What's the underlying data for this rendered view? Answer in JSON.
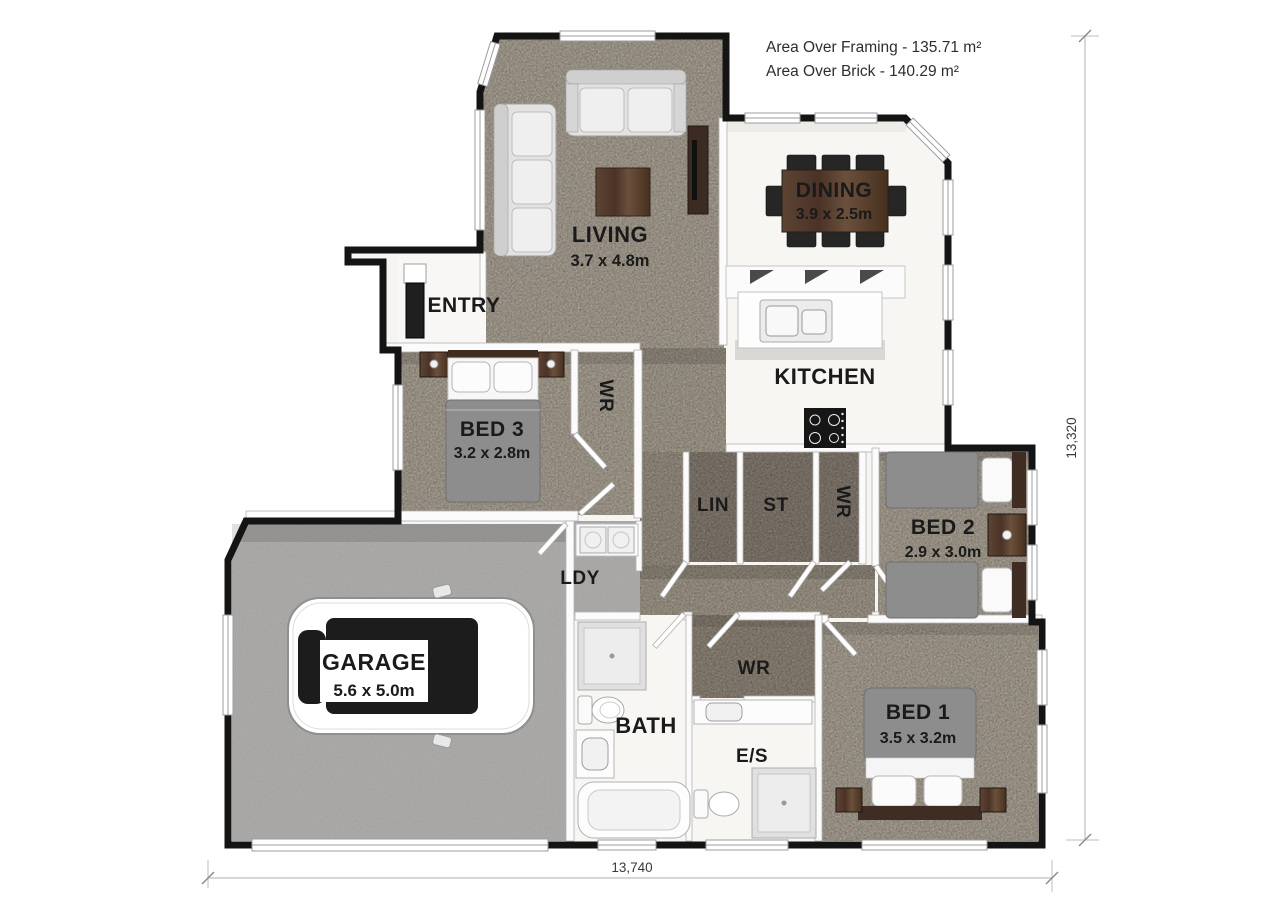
{
  "annotations": {
    "area_framing": "Area Over Framing - 135.71 m²",
    "area_brick": "Area Over Brick - 140.29 m²"
  },
  "dimensions": {
    "overall_width": "13,740",
    "overall_height": "13,320"
  },
  "rooms": {
    "living": {
      "label": "LIVING",
      "size": "3.7 x 4.8m"
    },
    "dining": {
      "label": "DINING",
      "size": "3.9 x 2.5m"
    },
    "kitchen": {
      "label": "KITCHEN"
    },
    "entry": {
      "label": "ENTRY"
    },
    "bed3": {
      "label": "BED 3",
      "size": "3.2 x 2.8m"
    },
    "bed3_wr": {
      "label": "WR"
    },
    "lin": {
      "label": "LIN"
    },
    "st": {
      "label": "ST"
    },
    "hall_wr": {
      "label": "WR"
    },
    "bed2": {
      "label": "BED 2",
      "size": "2.9 x 3.0m"
    },
    "ldy": {
      "label": "LDY"
    },
    "garage": {
      "label": "GARAGE",
      "size": "5.6 x 5.0m"
    },
    "bath": {
      "label": "BATH"
    },
    "bed1_wr": {
      "label": "WR"
    },
    "ensuite": {
      "label": "E/S"
    },
    "bed1": {
      "label": "BED 1",
      "size": "3.5 x 3.2m"
    }
  },
  "colors": {
    "carpet": "#c7beae",
    "closet_carpet": "#9c9285",
    "hard_floor": "#f7f6f3",
    "garage_floor": "#b8b7b5",
    "exterior_wall": "#141414",
    "wood": "#523a2e",
    "label_text": "#1a1a1a",
    "dimension_line": "#bdbdbd"
  }
}
